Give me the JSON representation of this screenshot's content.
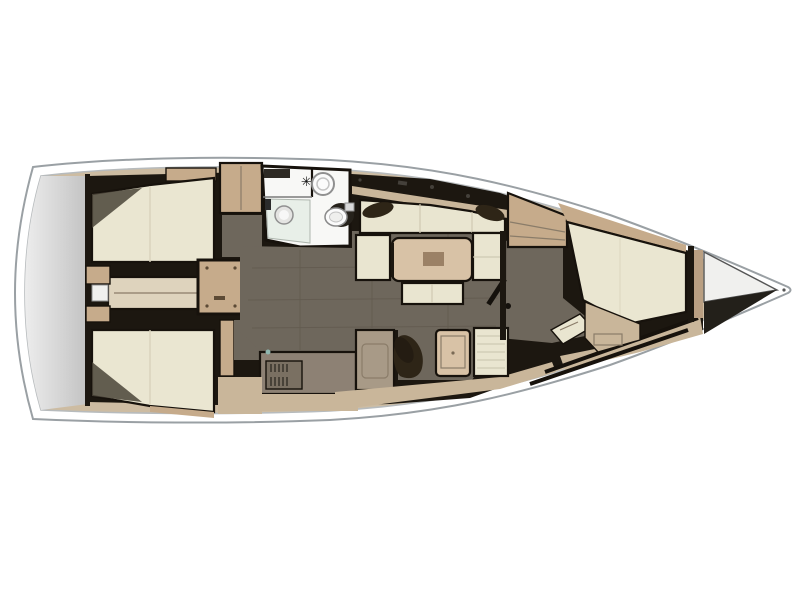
{
  "page": {
    "background": "#ffffff"
  },
  "colors": {
    "hull_outline": "#9aa0a4",
    "hull_white": "#ffffff",
    "inner_line": "#b7bbbd",
    "deck_beige": "#cdbca2",
    "transom_light": "#ededed",
    "transom_dark": "#c2c2c2",
    "structure_dark": "#1c1710",
    "floor_taupe": "#6e675c",
    "berth_cream": "#eae6d1",
    "cushion_cream": "#e9e5d0",
    "wood_tan": "#c6ab8b",
    "wood_light": "#d8c2a6",
    "wood_mid": "#b99f82",
    "wood_band": "#c9b69a",
    "corridor_beige": "#ded3bd",
    "counter_gray": "#8d8174",
    "stove_gray": "#7a7062",
    "cabinet_taupe": "#a89a87",
    "cabinet_inner": "#b5a794",
    "pillow_brown": "#2e2517",
    "head_white": "#f8f8f6",
    "shower_glass": "#e8efe8",
    "fixture_white": "#fbfbfb",
    "fixture_gray": "#e4e4e2",
    "locker_white": "#f0f0ee",
    "locker_shadow": "#23201a",
    "shadow_olive": "#4a4438",
    "table_center": "#9b8166",
    "tread_brown": "#8a6d4e",
    "faucet_teal": "#8fb6ae"
  },
  "icons": {
    "shower_mixer_glyph": "✳"
  }
}
